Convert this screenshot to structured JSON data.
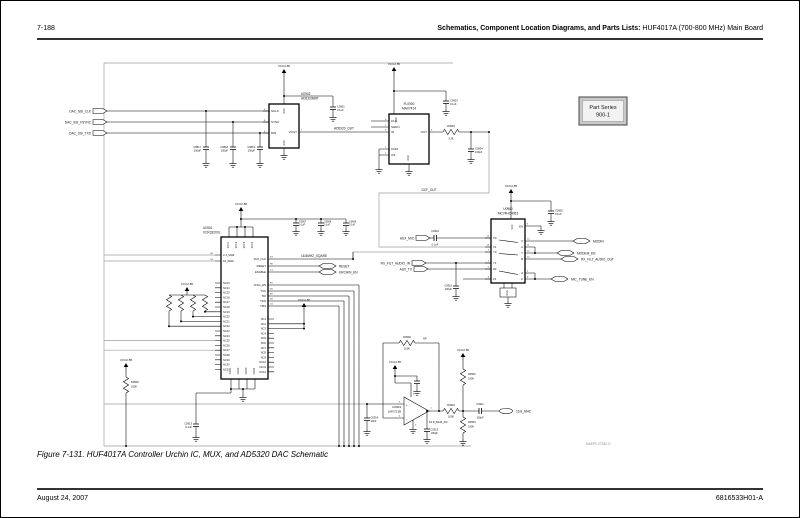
{
  "page": {
    "header_left": "7-188",
    "header_right_bold": "Schematics, Component Location Diagrams, and Parts Lists:",
    "header_right_normal": " HUF4017A (700-800 MHz) Main Board",
    "footer_left": "August 24, 2007",
    "footer_right": "6816533H01-A",
    "caption": "Figure 7-131. HUF4017A Controller Urchin IC, MUX, and AD5320 DAC Schematic",
    "watermark": "MAEPF-27332-O",
    "part_series_line1": "Part Series",
    "part_series_line2": "900-1"
  },
  "power": {
    "vcc": "VCC2.85"
  },
  "ports": {
    "dac_ssi_clk": "DAC_SSI_CLK",
    "dac_ssi_fsync": "DAC_SSI_FSYNC",
    "dac_ssi_txd": "DAC_SSI_TXD",
    "aux_mic": "AUX_MIC",
    "rx_filt_audio_in": "RX_FILT_AUDIO_IN",
    "aux_tx": "AUX_TX",
    "modin": "MODIN",
    "modem_en": "MODEM_EN",
    "rx_filt_audio_out": "RX_FILT_AUDIO_OUT",
    "mic_tune_en": "MIC_TUNE_EN",
    "reset_out": "RESET",
    "urchin_en": "URCHIN_EN",
    "clk_16_8": "16.8_MHZ"
  },
  "nets": {
    "ad5320_out": "AD5320_OUT",
    "gcf_out": "GCF_OUT",
    "sq_16_8": "16.8MHZ_SQARE",
    "dc_16_8": "16.8_MHZ_DC",
    "np": "NP"
  },
  "u0902": {
    "ref": "U0902",
    "part": "AD5320BRT",
    "pins": [
      "SCLK",
      "SYNC",
      "DIN"
    ],
    "nums": [
      "5",
      "6",
      "4"
    ],
    "vout": "VOUT",
    "vout_num": "1",
    "vdd": "VDD",
    "gnd": "GND"
  },
  "fl0900": {
    "ref": "FL0900",
    "part": "MAX7414",
    "pins": [
      "CLK",
      "SHDN",
      "IN",
      "COM",
      "OS"
    ],
    "nums": [
      "8",
      "7",
      "3",
      "1",
      "2"
    ],
    "out": "OUT",
    "out_num": "5",
    "vdd": "VDD",
    "gnd": "GND"
  },
  "u0901": {
    "ref": "U0901",
    "part": "XCR3320XL",
    "vcc_pins": [
      "VCC1",
      "VCC2",
      "VCC3",
      "VCC4"
    ],
    "gnd_pins": [
      "GND1",
      "GND2",
      "GND3",
      "GND4"
    ],
    "clk_pins": [
      {
        "des": "G7",
        "name": "2.4_MHZ"
      },
      {
        "des": "G1",
        "name": "16_MHZ"
      }
    ],
    "right_top": [
      {
        "des": "K3",
        "name": "16.8_CLK"
      },
      {
        "des": "H6",
        "name": "RESET"
      },
      {
        "des": "C1",
        "name": "ENABLE"
      }
    ],
    "jtag": [
      {
        "des": "E5",
        "name": "JTAG_EN"
      },
      {
        "des": "D5",
        "name": "TCK"
      },
      {
        "des": "B7",
        "name": "TDI"
      },
      {
        "des": "D6",
        "name": "TDO"
      },
      {
        "des": "C6",
        "name": "TMS"
      }
    ],
    "nc_left": [
      "NC13",
      "NC14",
      "NC15",
      "NC16",
      "NC17",
      "NC18",
      "NC19",
      "NC20",
      "NC21",
      "NC22",
      "NC23",
      "NC24",
      "NC25",
      "NC26",
      "NC27",
      "NC28",
      "NC29",
      "NC30",
      "NC31"
    ],
    "nc_right": [
      "NC1",
      "NC2",
      "NC3",
      "NC4",
      "NC5",
      "NC6",
      "NC7",
      "NC8",
      "NC9",
      "NC10",
      "NC11",
      "NC12"
    ]
  },
  "u0960": {
    "ref": "U0960",
    "part": "MC74HC4053",
    "left_labels": [
      "X0",
      "X1",
      "Y0",
      "Y1",
      "Z0",
      "Z1"
    ],
    "left_nums": [
      "12",
      "13",
      "2",
      "1",
      "5",
      "3"
    ],
    "right_labels": [
      "X",
      "A",
      "Y",
      "B",
      "Z",
      "C"
    ],
    "right_nums": [
      "14",
      "11",
      "15",
      "10",
      "4",
      "9"
    ],
    "en": "EN",
    "en_num": "6",
    "vcc": "VCC",
    "gnd": "GND"
  },
  "u0903": {
    "ref": "U0903",
    "part": "LMV721B",
    "plus": "+",
    "minus": "–",
    "num_plus": "3",
    "num_minus": "4",
    "num_out": "1",
    "num_vp": "5",
    "num_vm": "2"
  },
  "parts": {
    "c0817": {
      "ref": "C0817",
      "val": "100pF"
    },
    "c0818": {
      "ref": "C0818",
      "val": "100pF"
    },
    "c0819": {
      "ref": "C0819",
      "val": "100pF"
    },
    "c0901": {
      "ref": "C0901",
      "val": "0.1uF"
    },
    "c0903": {
      "ref": "C0903",
      "val": "0.1uF"
    },
    "c0904": {
      "ref": "C0904",
      "val": "100pF"
    },
    "c0905": {
      "ref": "C0905",
      "val": "0.1uF"
    },
    "c0907": {
      "ref": "C0907",
      "val": "0.1uF"
    },
    "c0908": {
      "ref": "C0908",
      "val": "0.1uF"
    },
    "c0909": {
      "ref": "C0909",
      "val": "0.1uF"
    },
    "c0910": {
      "ref": "C0910",
      "val": "0.1uF"
    },
    "c0911": {
      "ref": "C0911",
      "val": "100pF"
    },
    "c0912": {
      "ref": "C0912",
      "val": "100pF"
    },
    "c0913": {
      "ref": "C0913",
      "val": "0.1uF"
    },
    "c0914": {
      "ref": "C0914",
      "val": "33pF"
    },
    "c0915": {
      "ref": "C0915",
      "val": "100pF"
    },
    "r0900": {
      "ref": "R0900",
      "val": "100K"
    },
    "r0901": {
      "ref": "R0901",
      "val": "3.3K"
    },
    "r0902": {
      "ref": "R0902",
      "val": "100K"
    },
    "r0903": {
      "ref": "R0903",
      "val": "100K"
    },
    "r0904": {
      "ref": "R0904",
      "val": "100K"
    },
    "r0905": {
      "ref": "R0905",
      "val": "100K"
    }
  }
}
